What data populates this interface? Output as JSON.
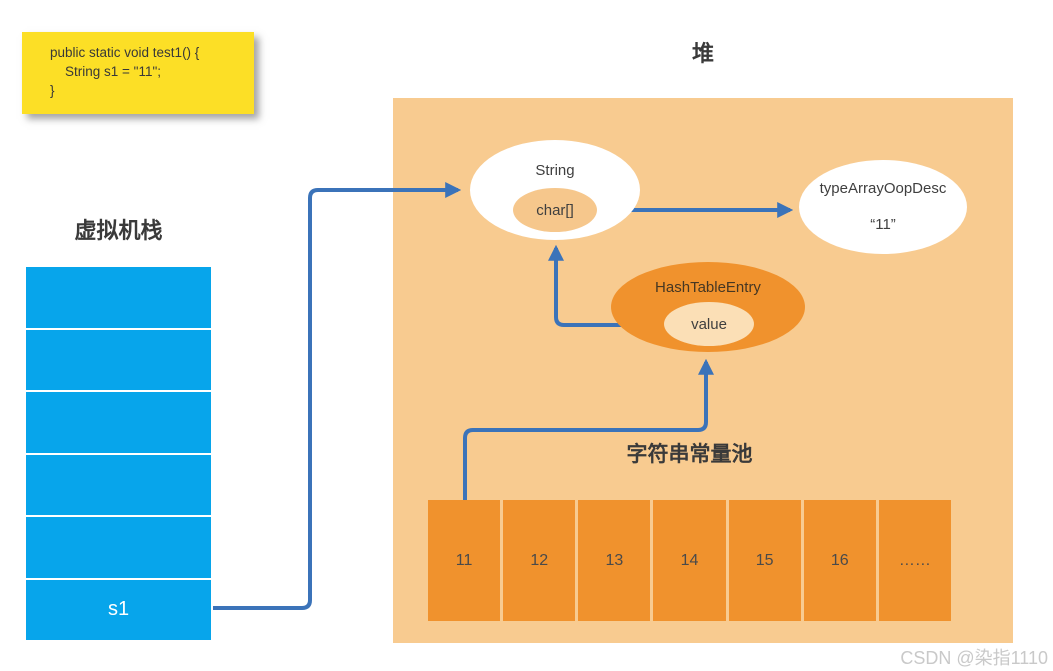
{
  "colors": {
    "stack_blue": "#07a5eb",
    "heap_background": "#f8cb90",
    "node_orange": "#f0922d",
    "value_peach": "#fbdfb6",
    "char_array_peach": "#f6c78c",
    "note_yellow": "#fcdf26",
    "arrow_blue": "#3b73b9"
  },
  "code_note": {
    "lines": [
      "public static void test1() {",
      "    String s1 = \"11\";",
      "}"
    ]
  },
  "stack": {
    "title": "虚拟机栈",
    "cells": [
      "",
      "",
      "",
      "",
      "",
      "s1"
    ]
  },
  "heap": {
    "title": "堆",
    "string_node": {
      "label": "String",
      "char_array_label": "char[]"
    },
    "type_array_node": {
      "label": "typeArrayOopDesc",
      "value": "“11”"
    },
    "hash_entry_node": {
      "label": "HashTableEntry",
      "value_label": "value"
    },
    "pool": {
      "label": "字符串常量池",
      "cells": [
        "11",
        "12",
        "13",
        "14",
        "15",
        "16",
        "……"
      ]
    }
  },
  "watermark": "CSDN @染指1110"
}
